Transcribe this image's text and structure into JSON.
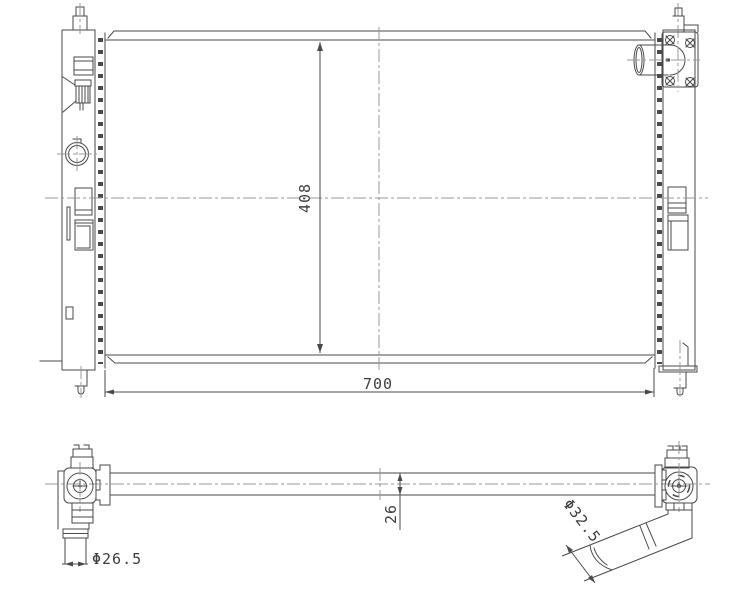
{
  "drawing": {
    "title": "Radiator two-view engineering drawing",
    "background": "#ffffff",
    "line_color": "#4a4a4a",
    "centerline_color": "#9a9a9a",
    "text_color": "#3d3d3d",
    "front_view": {
      "label": "front view",
      "dim_height": {
        "label": "408"
      },
      "dim_width": {
        "label": "700"
      }
    },
    "top_view": {
      "label": "top view",
      "dim_core_thickness": {
        "label": "26"
      },
      "dim_right_pipe": {
        "label": "Φ32.5"
      },
      "dim_left_pipe": {
        "label": "Φ26.5"
      }
    }
  }
}
